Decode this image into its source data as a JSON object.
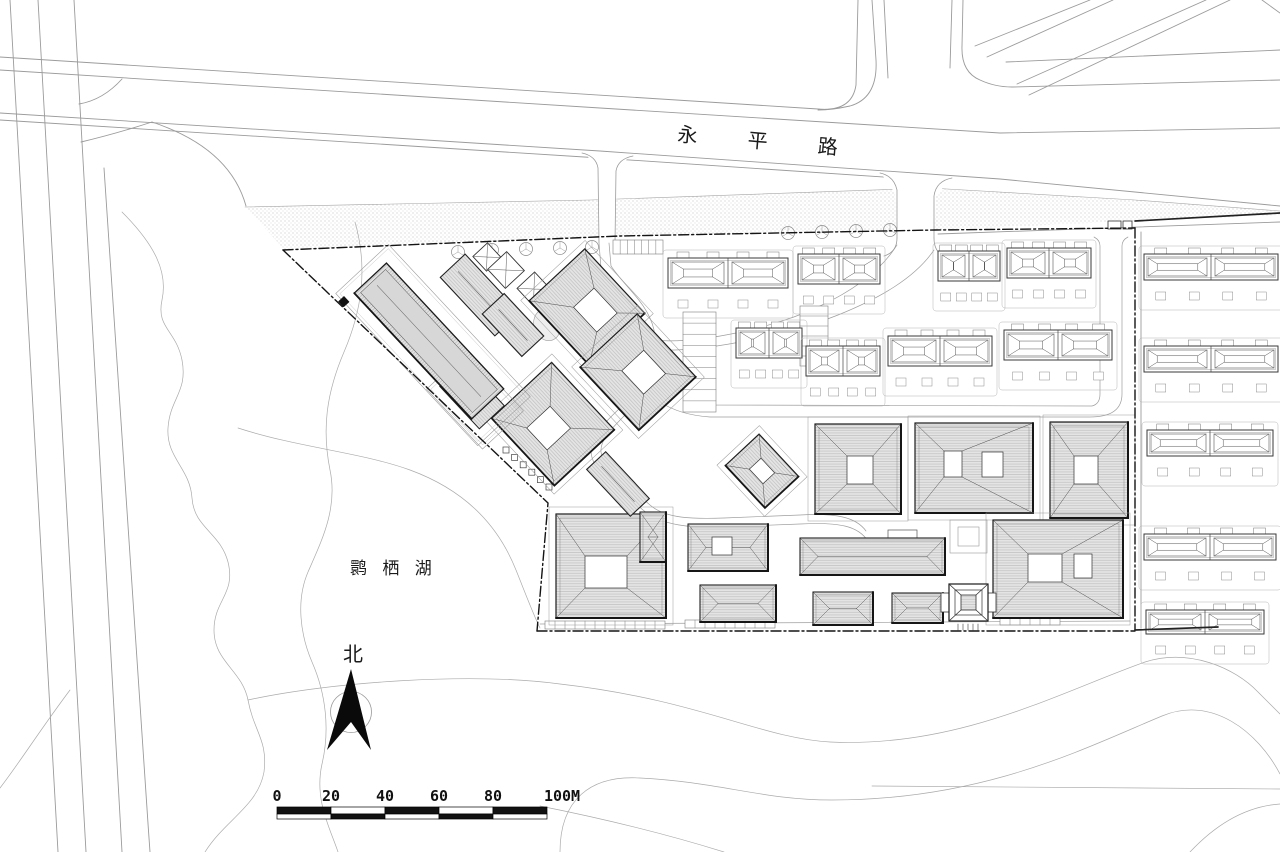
{
  "title": "residential site master plan",
  "labels": {
    "road": {
      "text": "永 平 路",
      "name": "yongping-road-label"
    },
    "lake": {
      "text": "鹮 栖 湖",
      "name": "huanqi-lake-label"
    },
    "north": {
      "text": "北",
      "name": "north-label"
    }
  },
  "scalebar": {
    "x": 277,
    "y": 807,
    "seg": 54,
    "h1": 7,
    "h2": 5,
    "labels": [
      "0",
      "20",
      "40",
      "60",
      "80",
      "100M"
    ],
    "label_xs": [
      277,
      331,
      385,
      439,
      493,
      562
    ]
  },
  "north_arrow": {
    "poly": "351,669 327,750 351,722 371,750",
    "circle": [
      351,
      712,
      20.5
    ]
  },
  "colors": {
    "road": "#9b9b9b",
    "light": "#ababab",
    "internal": "#9e9e9e",
    "boundary": "#141414",
    "context": "#555555",
    "bldg_stroke": "#1c1c1c",
    "bldg_fill": "#e4e4e4",
    "hatch": "#b6b6b6",
    "stipple": "#c6c6c6"
  },
  "plan": {
    "stipple_poly": "M245,207 L590,200 L930,188 L1135,200 L1280,211 L1280,215 L1135,221 L935,230 L620,237 L285,250 Z",
    "stipple_edge": "M245,207 L590,200 L930,188 L1135,200 L1280,211",
    "roads": [
      "M0,70 L600,108 L1000,133 L1280,128",
      "M0,113 L600,151 L1000,179 L1280,206",
      "M0,120 L600,158 L928,180",
      "M0,57 L818,109 Q852,112 856,85 L858,0",
      "M10,0 L58,852",
      "M38,0 L86,852",
      "M74,0 L122,852",
      "M104,168 C120,430 135,640 150,852",
      "M79,104 Q103,100 122,79",
      "M81,142 Q115,134 152,122",
      "M152,122 Q230,148 246,206",
      "M872,0 L876,60 Q878,98 850,106 Q832,110 818,110",
      "M884,0 L888,78",
      "M952,0 L950,68",
      "M963,0 L962,46 Q961,72 980,80 Q995,87 1012,87",
      "M975,46 L1090,0",
      "M987,57 L1113,0",
      "M1017,84 L1206,0",
      "M1029,95 L1230,0",
      "M1006,62 L1280,50",
      "M1012,87 L1280,80",
      "M1262,0 L1280,13",
      "M938,234 L1280,222",
      "M1141,232 L1141,628"
    ],
    "lake": [
      "M122,212 C155,245 168,272 162,300 C156,328 176,330 182,360 C188,392 170,398 168,428 C166,458 190,468 192,498 C194,528 220,532 228,562 C236,594 214,600 214,630 C214,662 242,670 248,700 C254,732 268,740 264,772 C258,806 225,820 205,852",
      "M355,222 C368,268 362,310 344,352 C326,394 322,430 330,470 C338,508 322,540 308,572 C296,600 300,634 312,662 C326,694 330,730 322,764 C314,800 330,828 338,852",
      "M248,700 C330,682 470,672 560,684 C700,700 760,738 830,742 C960,748 1060,692 1145,662 C1190,648 1235,668 1258,692 L1280,714",
      "M560,852 C560,800 590,775 640,778 C720,782 762,800 832,800 C985,800 1085,748 1162,716 C1212,695 1258,732 1280,774",
      "M872,786 L1280,789",
      "M540,806 C600,818 660,832 724,852",
      "M1190,852 C1220,820 1250,806 1280,804",
      "M70,690 C40,730 20,762 0,788",
      "M238,428 C300,448 360,452 410,470 C470,492 500,530 516,570 C528,600 534,616 540,628"
    ],
    "internal": [
      "M599,243 L601,268 C615,288 640,305 646,332 C650,362 638,390 620,408 C600,427 590,438 591,452 C592,466 604,478 620,490 L643,510 C662,526 692,528 722,527 L800,524 C840,522 858,526 868,541",
      "M609,243 L611,266 C624,286 648,303 654,330 C658,362 646,392 628,412 C610,430 600,440 601,452 C602,463 613,474 628,486 L650,505 C666,519 694,519 724,518 L800,515 C836,513 856,517 866,531",
      "M897,245 C880,272 850,292 820,306 C780,326 700,345 652,340",
      "M934,250 C915,278 880,298 838,315 C795,332 712,352 658,350",
      "M672,380 Q690,400 715,405 L1092,406 Q1100,404 1100,394 L1100,246 Q1100,240 1094,237",
      "M660,402 Q680,415 710,417 L1090,417 Q1122,417 1122,394 L1122,246 Q1122,240 1128,237",
      "M540,624 L1130,621"
    ],
    "entr_white": [
      "M880,172 L952,177 L936,196 L934,240 L897,240 L895,193 Z",
      "M584,151 L631,154 L617,172 L615,243 L599,243 L597,170 Z"
    ],
    "entr_edges": [
      "M880,173 Q894,176 897,190 L897,238",
      "M952,178 Q936,181 934,196 L934,238",
      "M897,238 Q897,252 884,256",
      "M934,238 Q934,254 948,258",
      "M582,153 Q596,156 598,168 L599,243",
      "M633,156 Q618,159 616,171 L615,243"
    ],
    "boundary_dash": [
      "M283,250 L620,236 L935,230 L1135,228",
      "M1135,228 L1135,630",
      "M537,631 L1135,631",
      "M283,250 L548,503 L537,631"
    ],
    "boundary_solid": [
      "M1135,221 L1280,213",
      "M1135,630 L1218,627"
    ],
    "trees": [
      [
        458,
        252
      ],
      [
        492,
        250
      ],
      [
        526,
        249
      ],
      [
        560,
        248
      ],
      [
        592,
        247
      ],
      [
        788,
        233
      ],
      [
        822,
        232
      ],
      [
        856,
        231
      ],
      [
        890,
        230
      ]
    ],
    "ladders": [
      {
        "x": 613,
        "y": 240,
        "w": 50,
        "h": 14,
        "n": 7,
        "vert": true
      },
      {
        "x": 683,
        "y": 312,
        "w": 33,
        "h": 100,
        "n": 9,
        "vert": false
      },
      {
        "x": 800,
        "y": 306,
        "w": 28,
        "h": 60,
        "n": 6,
        "vert": false
      },
      {
        "x": 545,
        "y": 621,
        "w": 120,
        "h": 8,
        "n": 12,
        "vert": true
      },
      {
        "x": 685,
        "y": 620,
        "w": 90,
        "h": 8,
        "n": 9,
        "vert": true
      },
      {
        "x": 1000,
        "y": 617,
        "w": 60,
        "h": 8,
        "n": 6,
        "vert": true
      }
    ],
    "ticks": {
      "x1": 506,
      "y1": 450,
      "x2": 549,
      "y2": 487,
      "n": 6,
      "s": 6
    },
    "marker": [
      344,
      296,
      8,
      8,
      47
    ],
    "gates": [
      [
        1108,
        221,
        13,
        8
      ],
      [
        1123,
        221,
        9,
        8
      ]
    ],
    "plaza": [
      [
        950,
        520,
        37,
        33
      ],
      [
        958,
        527,
        21,
        19
      ]
    ],
    "pond": [
      547,
      325,
      13,
      16
    ],
    "slab": {
      "cx": 429,
      "cy": 341,
      "l": 172,
      "w": 44,
      "a": 47,
      "tail": [
        472,
        396,
        58,
        34
      ],
      "pods": [
        [
          433,
          345,
          208,
          72
        ],
        [
          475,
          400,
          82,
          56
        ]
      ]
    },
    "rbars": [
      [
        480,
        295,
        80,
        34,
        47
      ],
      [
        513,
        325,
        58,
        30,
        47
      ],
      [
        618,
        484,
        64,
        26,
        47
      ]
    ],
    "rwhites": [
      [
        487,
        257,
        20
      ],
      [
        506,
        270,
        26
      ],
      [
        534,
        289,
        24
      ]
    ],
    "rcourts": [
      [
        587,
        307,
        88,
        76,
        8,
        -4,
        34,
        28
      ],
      [
        553,
        424,
        92,
        82,
        0,
        6,
        30,
        32
      ],
      [
        638,
        372,
        86,
        78,
        4,
        -4,
        32,
        30
      ],
      [
        762,
        471,
        58,
        46,
        0,
        0,
        20,
        16
      ]
    ],
    "courts": [
      {
        "x": 815,
        "y": 424,
        "w": 86,
        "h": 90,
        "courts": [
          [
            847,
            456,
            26,
            28
          ]
        ]
      },
      {
        "x": 915,
        "y": 423,
        "w": 118,
        "h": 90,
        "courts": [
          [
            944,
            451,
            18,
            26
          ],
          [
            982,
            452,
            21,
            25
          ]
        ]
      },
      {
        "x": 1050,
        "y": 422,
        "w": 78,
        "h": 96,
        "courts": [
          [
            1074,
            456,
            24,
            28
          ]
        ]
      },
      {
        "x": 993,
        "y": 520,
        "w": 130,
        "h": 98,
        "courts": [
          [
            1028,
            554,
            34,
            28
          ],
          [
            1074,
            554,
            18,
            24
          ]
        ]
      },
      {
        "x": 556,
        "y": 514,
        "w": 110,
        "h": 104,
        "courts": [
          [
            585,
            556,
            42,
            32
          ]
        ]
      }
    ],
    "bars": [
      {
        "x": 688,
        "y": 524,
        "w": 80,
        "h": 47,
        "court": [
          712,
          537,
          20,
          18
        ]
      },
      {
        "x": 800,
        "y": 538,
        "w": 145,
        "h": 37,
        "step": [
          888,
          530,
          29,
          8
        ]
      },
      {
        "x": 700,
        "y": 585,
        "w": 76,
        "h": 37
      },
      {
        "x": 813,
        "y": 592,
        "w": 60,
        "h": 33
      },
      {
        "x": 892,
        "y": 593,
        "w": 51,
        "h": 30
      },
      {
        "x": 640,
        "y": 512,
        "w": 26,
        "h": 50
      }
    ],
    "pagoda": {
      "x": 949,
      "y": 584,
      "w": 39,
      "h": 37
    },
    "rows": [
      [
        668,
        258,
        120,
        30
      ],
      [
        798,
        254,
        82,
        30
      ],
      [
        938,
        251,
        62,
        30
      ],
      [
        1007,
        248,
        84,
        30
      ],
      [
        736,
        328,
        66,
        30
      ],
      [
        806,
        346,
        74,
        30
      ],
      [
        888,
        336,
        104,
        30
      ],
      [
        1004,
        330,
        108,
        30
      ],
      [
        1144,
        254,
        134,
        26
      ],
      [
        1144,
        346,
        134,
        26
      ],
      [
        1147,
        430,
        126,
        26
      ],
      [
        1144,
        534,
        132,
        26
      ],
      [
        1146,
        610,
        118,
        24
      ]
    ]
  }
}
